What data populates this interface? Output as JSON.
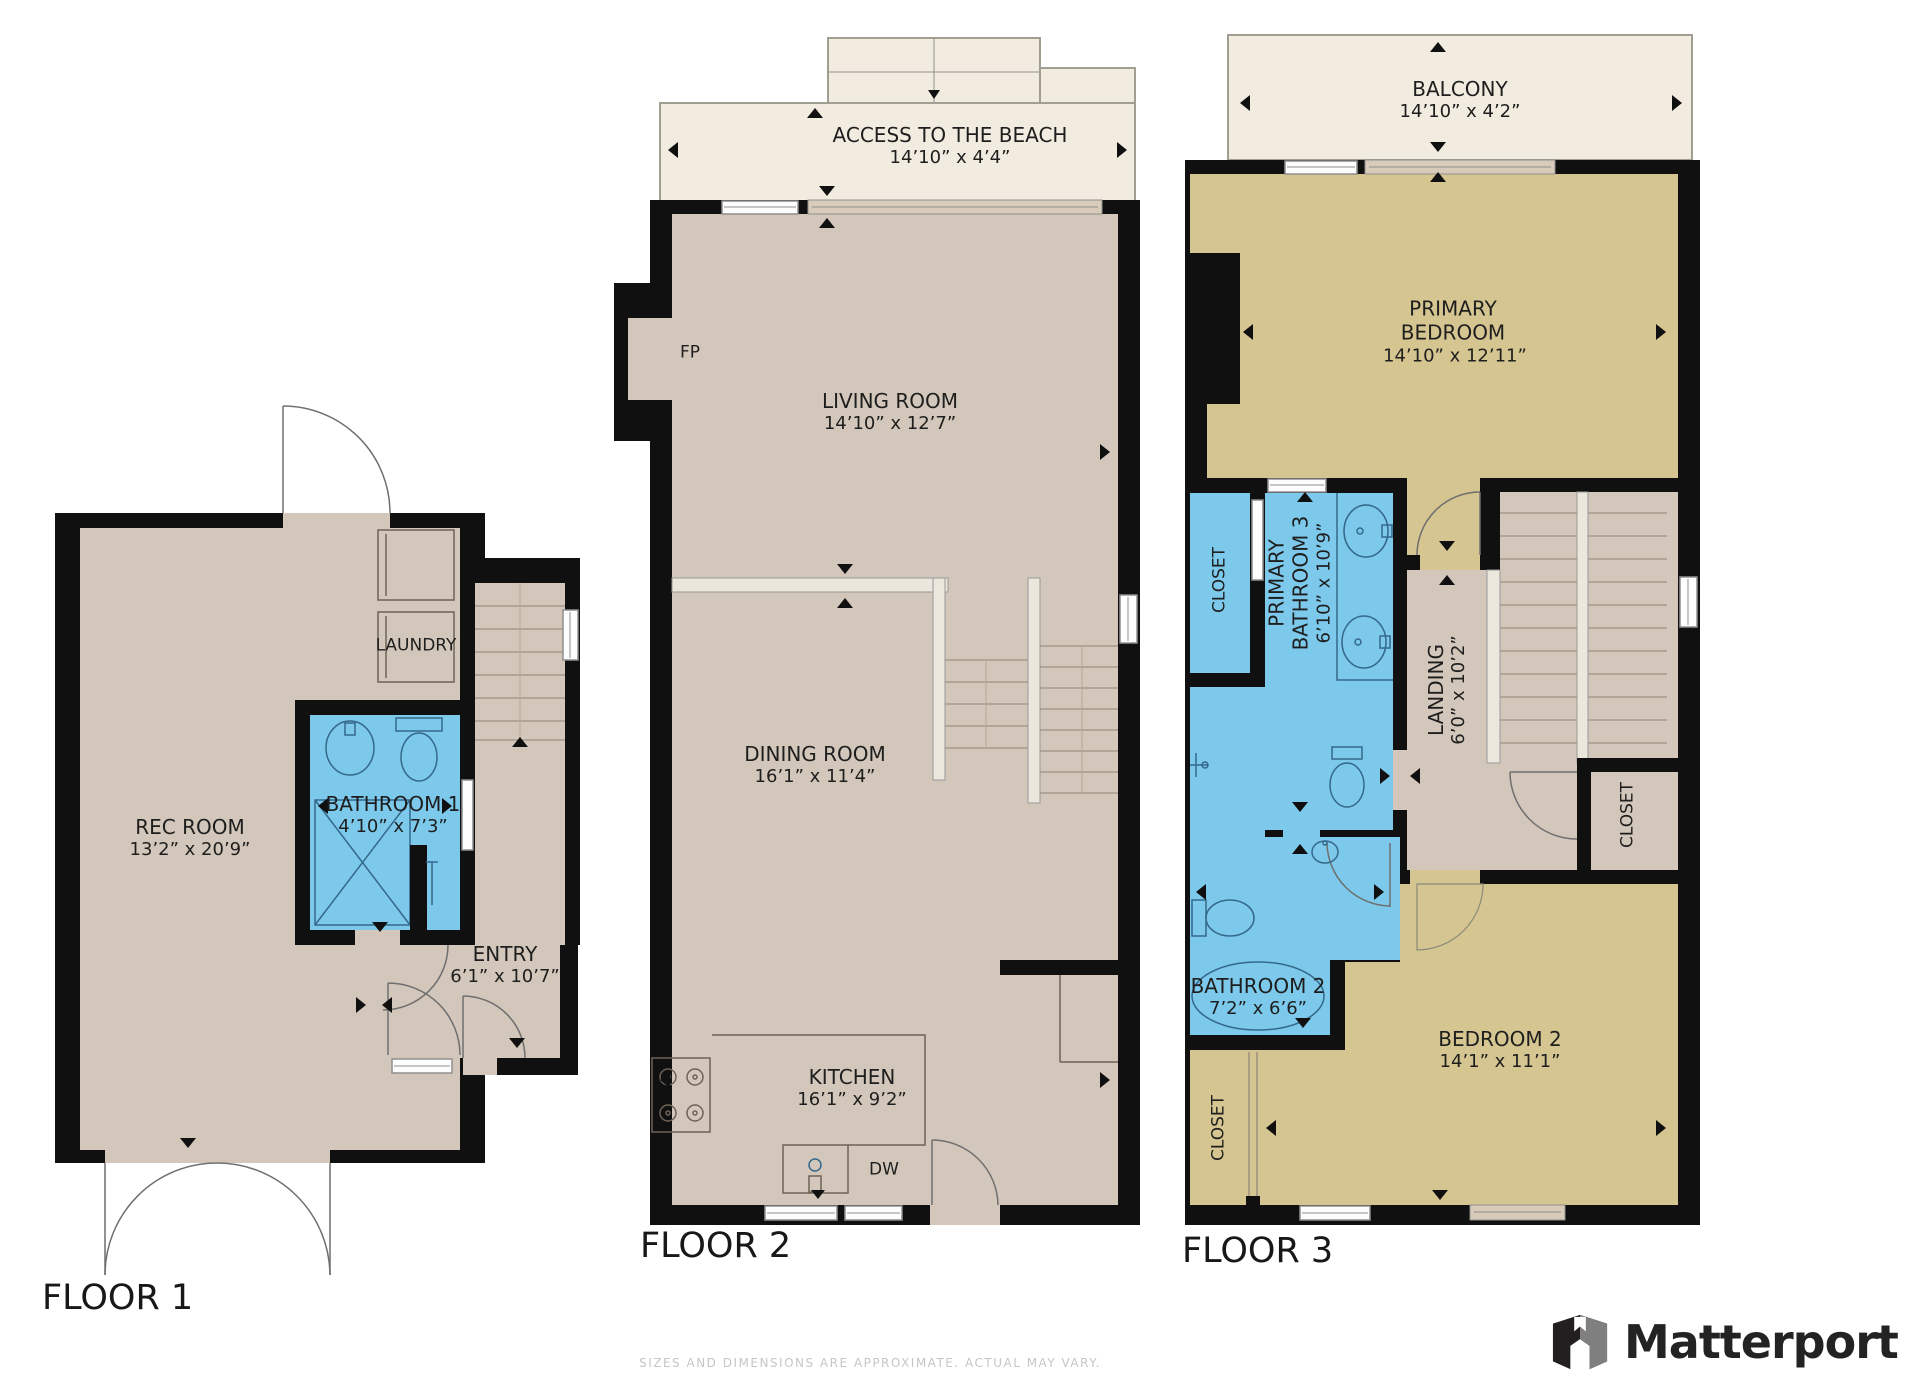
{
  "page": {
    "brand": "Matterport",
    "disclaimer": "SIZES AND DIMENSIONS ARE APPROXIMATE. ACTUAL MAY VARY."
  },
  "colors": {
    "wall": "#101010",
    "floor": "#d2c7ba",
    "bedroom_floor": "#d5c590",
    "bathroom_floor": "#7cc9eb",
    "outdoor": "#f1ecdf",
    "brand_text": "#232323"
  },
  "floors": [
    {
      "label": "FLOOR 1",
      "rooms": [
        {
          "name": "REC ROOM",
          "dims": "13’2” x 20’9”"
        },
        {
          "name": "LAUNDRY",
          "dims": ""
        },
        {
          "name": "BATHROOM 1",
          "dims": "4’10” x 7’3”"
        },
        {
          "name": "ENTRY",
          "dims": "6’1” x 10’7”"
        }
      ]
    },
    {
      "label": "FLOOR 2",
      "rooms": [
        {
          "name": "ACCESS TO THE BEACH",
          "dims": "14’10” x 4’4”"
        },
        {
          "name": "FP",
          "dims": ""
        },
        {
          "name": "LIVING ROOM",
          "dims": "14’10” x 12’7”"
        },
        {
          "name": "DINING ROOM",
          "dims": "16’1” x 11’4”"
        },
        {
          "name": "KITCHEN",
          "dims": "16’1” x 9’2”"
        },
        {
          "name": "DW",
          "dims": ""
        }
      ]
    },
    {
      "label": "FLOOR 3",
      "rooms": [
        {
          "name": "BALCONY",
          "dims": "14’10” x 4’2”"
        },
        {
          "name": "PRIMARY BEDROOM",
          "dims": "14’10” x 12’11”"
        },
        {
          "name": "CLOSET",
          "dims": ""
        },
        {
          "name": "PRIMARY BATHROOM 3",
          "dims": "6’10” x 10’9”"
        },
        {
          "name": "LANDING",
          "dims": "6’0” x 10’2”"
        },
        {
          "name": "CLOSET",
          "dims": ""
        },
        {
          "name": "BATHROOM 2",
          "dims": "7’2” x 6’6”"
        },
        {
          "name": "BEDROOM 2",
          "dims": "14’1” x 11’1”"
        },
        {
          "name": "CLOSET",
          "dims": ""
        }
      ]
    }
  ]
}
